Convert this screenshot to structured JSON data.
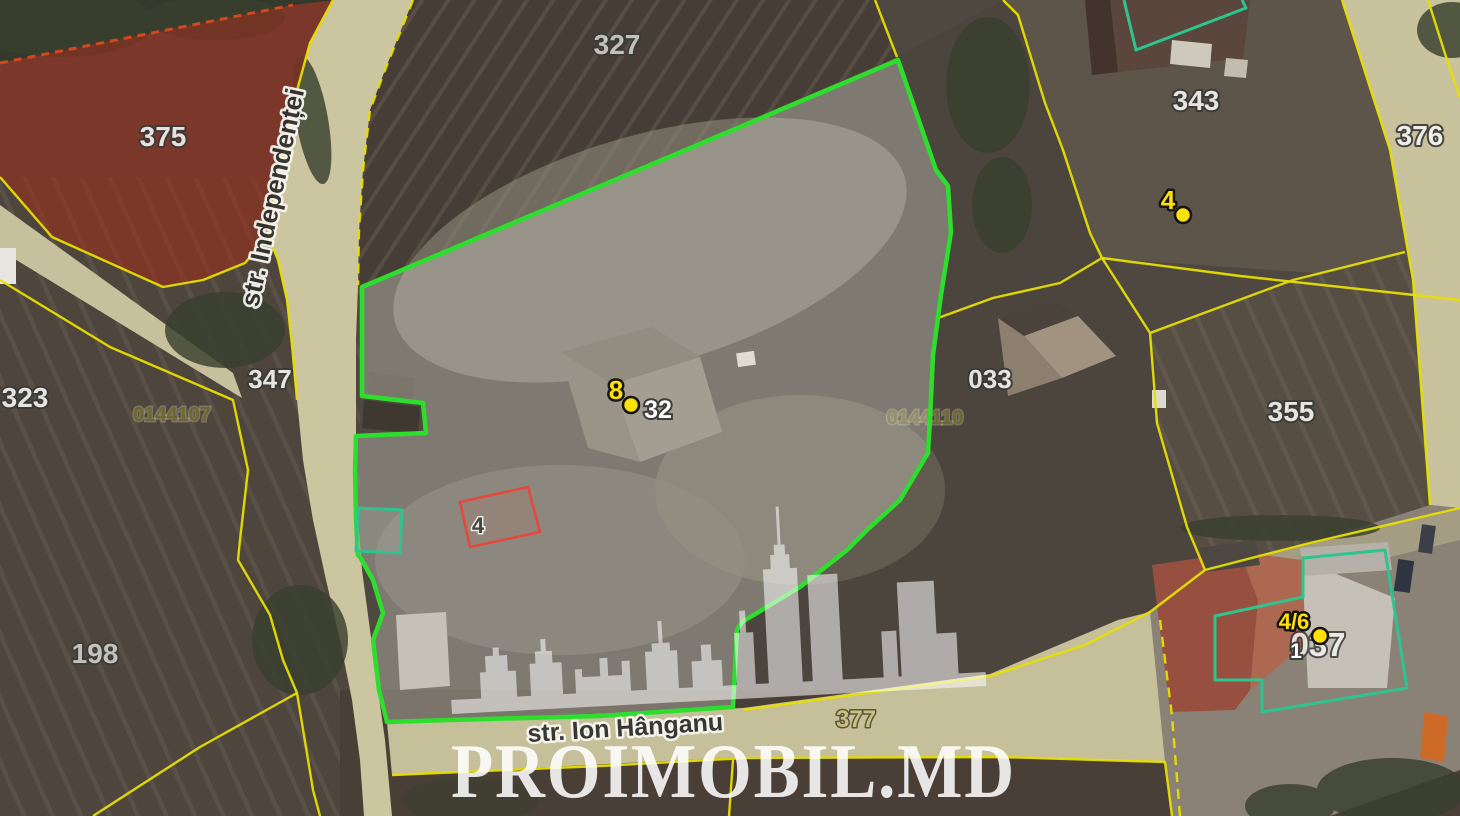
{
  "map": {
    "watermark": {
      "brand": "PROIMOBIL.MD",
      "icon": "city-skyline"
    },
    "streets": {
      "independentei": "str. Independenței",
      "ion_hanganu": "str. Ion Hânganu"
    },
    "parcels": {
      "p375": "375",
      "p327": "327",
      "p343": "343",
      "p376": "376",
      "p323": "323",
      "p347": "347",
      "p355": "355",
      "p033": "033",
      "p198": "198",
      "p377": "377",
      "p037": "037"
    },
    "codes": {
      "c107": "0144107",
      "c110": "0144110"
    },
    "markers": {
      "m8": {
        "number": "8",
        "house": "32"
      },
      "m4": {
        "number": "4"
      },
      "m46": {
        "number": "4/6",
        "house": "1"
      }
    },
    "plot_label": "4",
    "colors": {
      "selected_boundary": "#2ddf2d",
      "selected_fill": "rgba(240,238,230,0.30)",
      "cadastral_line": "#e7df00",
      "boundary_dashed_red": "#cf481f",
      "red_zone_fill": "rgba(160,44,24,0.55)",
      "plot_outline_red": "#e8473b",
      "building_outline_teal": "#2fc48e",
      "marker_yellow": "#ffe10a",
      "label_white": "#f2f2ee",
      "label_outline": "#3a3a38",
      "code_olive": "#6f682e",
      "watermark_white": "rgba(255,255,255,0.87)"
    }
  }
}
